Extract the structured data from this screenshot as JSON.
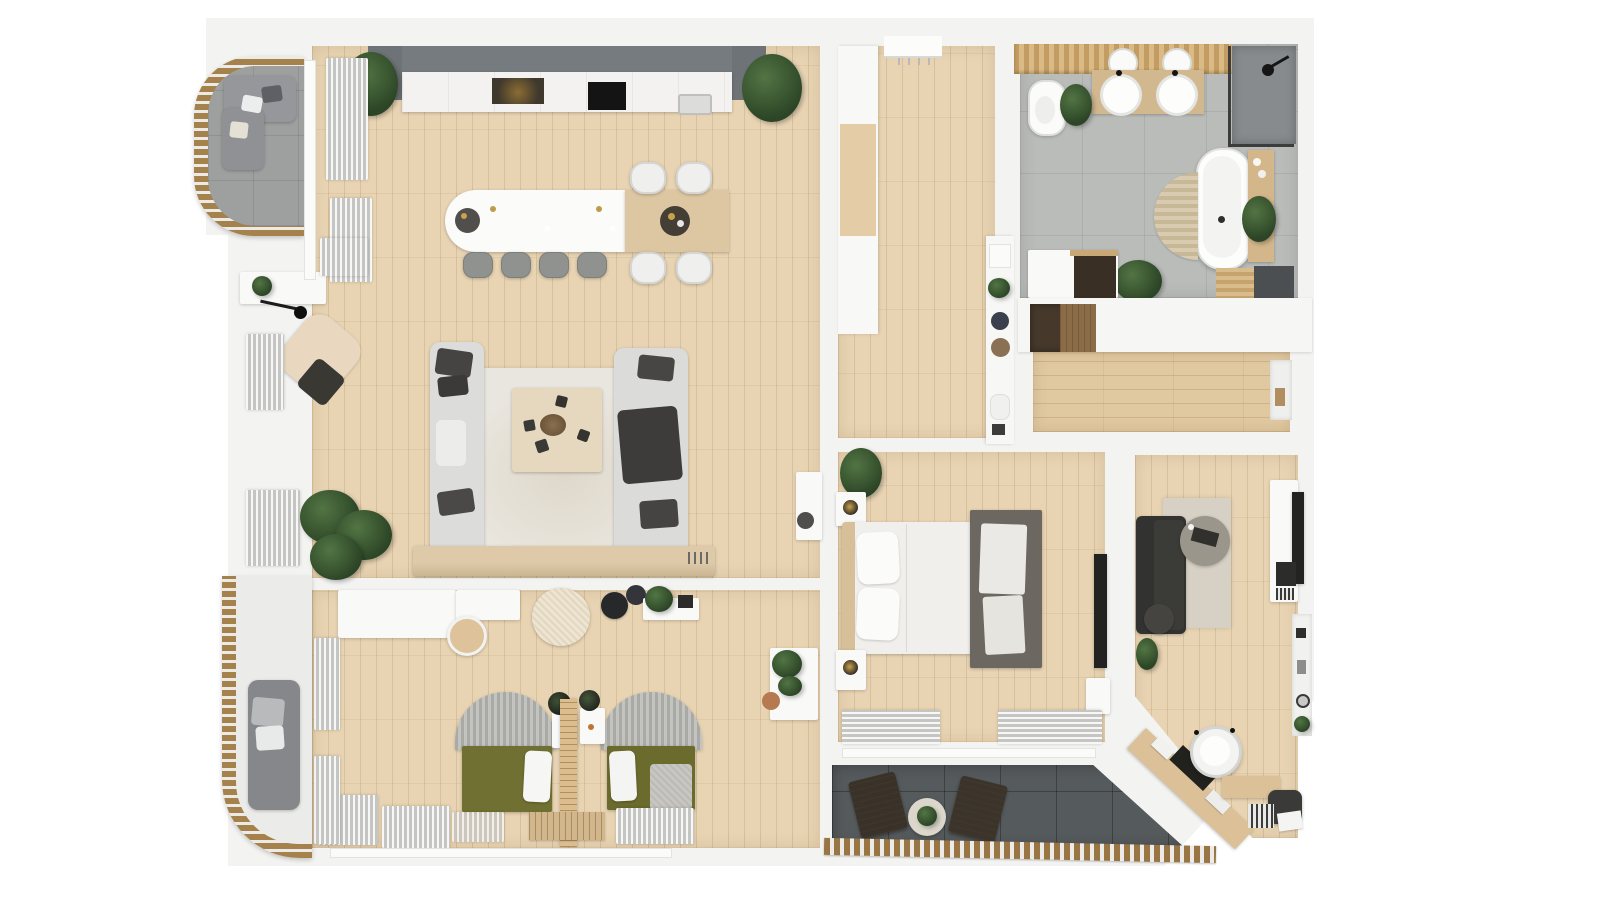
{
  "meta": {
    "title": "Top-down 3D rendered floor plan of an apartment",
    "view": "orthographic top view render",
    "visible_text": "none"
  },
  "palette": {
    "background": "#ffffff",
    "wall_white": "#f3f3f1",
    "wood_floor": "#e8d4b3",
    "wood_corridor": "#e0c8a0",
    "bath_tile_gray": "#babcb9",
    "terrace_tile_dark": "#555a5c",
    "balcony_tile_gray": "#9da09e",
    "railing_wood": "#997543",
    "kitchen_cabinet_gray": "#767b7f",
    "sofa_light_gray": "#dcdcda",
    "pillow_charcoal": "#454442",
    "armchair_beige": "#e9d8bf",
    "bed_olive": "#6f7031",
    "office_sofa_charcoal": "#323230",
    "plant_green": "#3b5a30",
    "vanity_wood": "#d2b88e"
  },
  "rooms": [
    {
      "id": "living-kitchen",
      "label": "Open living room with kitchen and dining",
      "floor": "light oak planks",
      "furniture": [
        "kitchen upper cabinet run",
        "kitchen counter with oven, hob and sink",
        "kitchen island with sink",
        "dining table extension",
        "4 bar stools",
        "4 dining chairs",
        "two facing light gray sofas",
        "coffee table",
        "area rug",
        "media bench",
        "beige reading armchair",
        "floor lamp",
        "console table",
        "monstera plant",
        "corner plants",
        "window curtains"
      ]
    },
    {
      "id": "kids-bedroom",
      "label": "Bedroom with two single beds",
      "floor": "light oak planks",
      "furniture": [
        "white corner desk",
        "desk chair",
        "knitted pouf",
        "two dark poufs",
        "wall shelf with plant",
        "two arched headboard beds",
        "olive green bedding",
        "slatted room divider",
        "nightstands with plants",
        "bench",
        "window curtains",
        "console with plants"
      ]
    },
    {
      "id": "entry-hall",
      "label": "Entry hall",
      "floor": "light oak planks",
      "furniture": [
        "entry door",
        "built-in wardrobe with wood inset",
        "tall decor shelf"
      ]
    },
    {
      "id": "bathroom",
      "label": "Bathroom",
      "floor": "gray concrete tiles",
      "furniture": [
        "wood slat feature wall",
        "toilet",
        "double vessel sink vanity",
        "two round mirrors",
        "walk-in shower with glass screen",
        "freestanding oval bathtub",
        "half-round bath mat",
        "wood bath caddy",
        "plants",
        "storage cabinet",
        "wood floor mat"
      ]
    },
    {
      "id": "corridor",
      "label": "Inner corridor",
      "floor": "oak planks (horizontal)",
      "furniture": [
        "built-in white cabinets",
        "open dark closet",
        "wall niche"
      ]
    },
    {
      "id": "master-bedroom",
      "label": "Master bedroom",
      "floor": "light oak planks",
      "furniture": [
        "double bed with wood headboard",
        "two nightstands with lamps",
        "plant",
        "dark gray rug with throw",
        "wall-mounted TV",
        "dresser",
        "window curtains"
      ]
    },
    {
      "id": "office",
      "label": "Office / den with diagonal wall",
      "floor": "light oak planks",
      "furniture": [
        "charcoal sofa",
        "beige rug",
        "round concrete coffee table",
        "pouf",
        "plant",
        "white media unit with TV",
        "wall shelf niche",
        "diagonal wood desk with laptop",
        "white desk chair",
        "desk return",
        "storage pouf with printer",
        "book stacks"
      ]
    },
    {
      "id": "terrace",
      "label": "Loggia terrace",
      "floor": "dark gray tiles",
      "furniture": [
        "two dark lounge chairs",
        "round plant table",
        "wood slat railing"
      ]
    },
    {
      "id": "balcony-top-left",
      "label": "Curved balcony (top left)",
      "floor": "gray tiles",
      "furniture": [
        "curved wood slat railing",
        "gray corner sofa with pillows"
      ]
    },
    {
      "id": "balcony-bottom-left",
      "label": "Curved balcony (bottom left)",
      "floor": "light gray decking",
      "furniture": [
        "curved wood slat railing",
        "gray lounge chair with pillows"
      ]
    }
  ]
}
